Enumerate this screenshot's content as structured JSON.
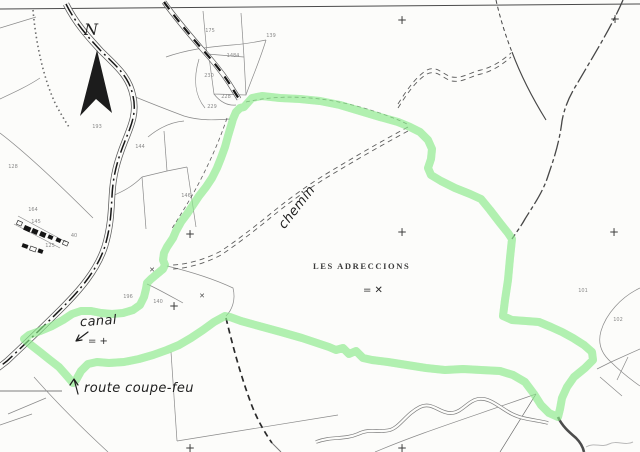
{
  "map": {
    "place_name": "LES ADRECCIONS",
    "north_label": "N",
    "annotations": {
      "canal": "canal",
      "route_coupe_feu": "route coupe-feu",
      "chemin": "chemin",
      "canal_mark": "= +",
      "place_mark": "= ✕"
    },
    "colors": {
      "highlight": "#53DC57",
      "highlight_glow": "#8BEC8B",
      "paper": "#fcfcfa",
      "ink": "#2b2b2b"
    },
    "marks": [
      {
        "x": 210,
        "y": 31,
        "label": "175",
        "cls": "pnum"
      },
      {
        "x": 271,
        "y": 36,
        "label": "139",
        "cls": "pnum"
      },
      {
        "x": 233,
        "y": 56,
        "label": "1484",
        "cls": "pnum"
      },
      {
        "x": 209,
        "y": 76,
        "label": "230",
        "cls": "pnum"
      },
      {
        "x": 226,
        "y": 97,
        "label": "228",
        "cls": "pnum"
      },
      {
        "x": 212,
        "y": 107,
        "label": "229",
        "cls": "pnum"
      },
      {
        "x": 97,
        "y": 127,
        "label": "193",
        "cls": "pnum"
      },
      {
        "x": 140,
        "y": 147,
        "label": "144",
        "cls": "pnum"
      },
      {
        "x": 13,
        "y": 167,
        "label": "128",
        "cls": "pnum"
      },
      {
        "x": 186,
        "y": 196,
        "label": "146",
        "cls": "pnum"
      },
      {
        "x": 33,
        "y": 210,
        "label": "164",
        "cls": "pnum"
      },
      {
        "x": 36,
        "y": 222,
        "label": "145",
        "cls": "pnum"
      },
      {
        "x": 74,
        "y": 236,
        "label": "40",
        "cls": "pnum"
      },
      {
        "x": 50,
        "y": 246,
        "label": "125",
        "cls": "pnum"
      },
      {
        "x": 128,
        "y": 297,
        "label": "196",
        "cls": "pnum"
      },
      {
        "x": 158,
        "y": 302,
        "label": "140",
        "cls": "pnum"
      },
      {
        "x": 583,
        "y": 291,
        "label": "101",
        "cls": "pnum"
      },
      {
        "x": 618,
        "y": 320,
        "label": "102",
        "cls": "pnum"
      },
      {
        "x": 402,
        "y": 20,
        "label": "+",
        "cls": "cross"
      },
      {
        "x": 615,
        "y": 19,
        "label": "+",
        "cls": "cross"
      },
      {
        "x": 190,
        "y": 234,
        "label": "+",
        "cls": "cross"
      },
      {
        "x": 402,
        "y": 232,
        "label": "+",
        "cls": "cross"
      },
      {
        "x": 614,
        "y": 232,
        "label": "+",
        "cls": "cross"
      },
      {
        "x": 174,
        "y": 306,
        "label": "+",
        "cls": "cross"
      },
      {
        "x": 190,
        "y": 448,
        "label": "+",
        "cls": "cross"
      },
      {
        "x": 402,
        "y": 448,
        "label": "+",
        "cls": "cross"
      },
      {
        "x": 152,
        "y": 270,
        "label": "✕",
        "cls": "xmark"
      },
      {
        "x": 202,
        "y": 296,
        "label": "✕",
        "cls": "xmark"
      }
    ]
  }
}
